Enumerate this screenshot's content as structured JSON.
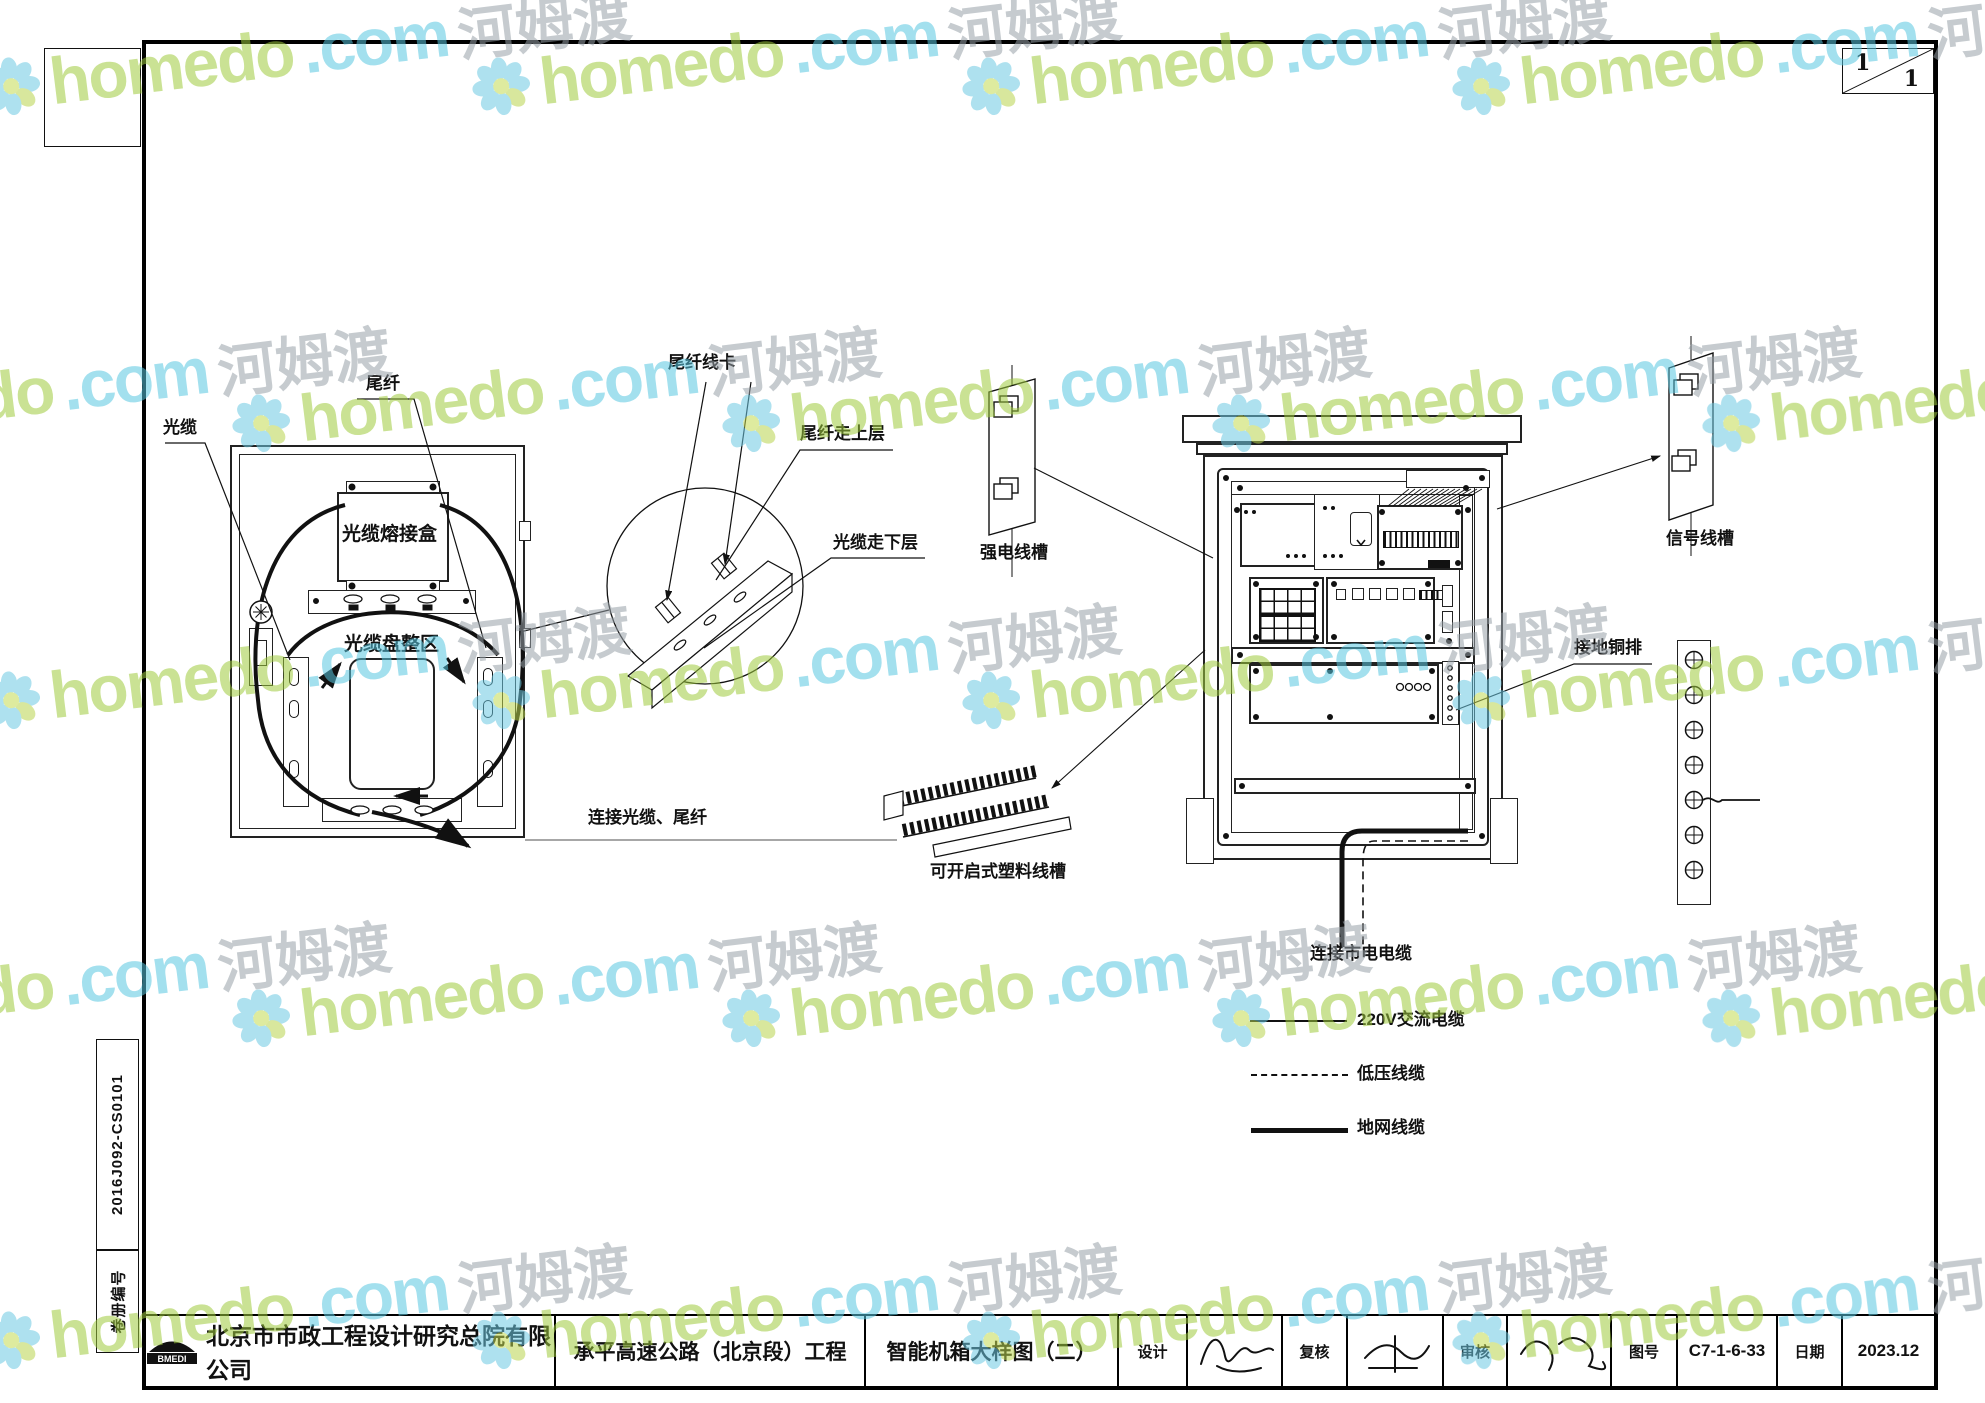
{
  "sheet": {
    "corner_index": {
      "top": "1",
      "bottom": "1"
    },
    "side_labels": {
      "volume_no": "2016J092-CS0101",
      "volume_label": "卷册编号"
    }
  },
  "diagram_labels": {
    "cable": "光缆",
    "pigtail": "尾纤",
    "splice_box": "光缆熔接盒",
    "coil_area": "光缆盘整区",
    "connect_fiber": "连接光缆、尾纤",
    "pigtail_clip": "尾纤线卡",
    "pigtail_upper": "尾纤走上层",
    "cable_lower": "光缆走下层",
    "strong_raceway": "强电线槽",
    "signal_raceway": "信号线槽",
    "ground_busbar": "接地铜排",
    "plastic_raceway": "可开启式塑料线槽",
    "mains_cable": "连接市电电缆"
  },
  "legend": {
    "items": [
      {
        "label": "220V交流电缆",
        "line": "solid-thin"
      },
      {
        "label": "低压线缆",
        "line": "dashed"
      },
      {
        "label": "地网线缆",
        "line": "solid-thick"
      }
    ]
  },
  "title_block": {
    "logo_text": "BMEDI",
    "company": "北京市市政工程设计研究总院有限公司",
    "project": "承平高速公路（北京段）工程",
    "drawing_title": "智能机箱大样图（二）",
    "design_label": "设计",
    "review_label": "复核",
    "audit_label": "审核",
    "drawing_no_label": "图号",
    "drawing_no": "C7-1-6-33",
    "date_label": "日期",
    "date": "2023.12"
  },
  "watermark": {
    "brand": "homedo",
    "tld": ".com",
    "cn": "河姆渡"
  }
}
